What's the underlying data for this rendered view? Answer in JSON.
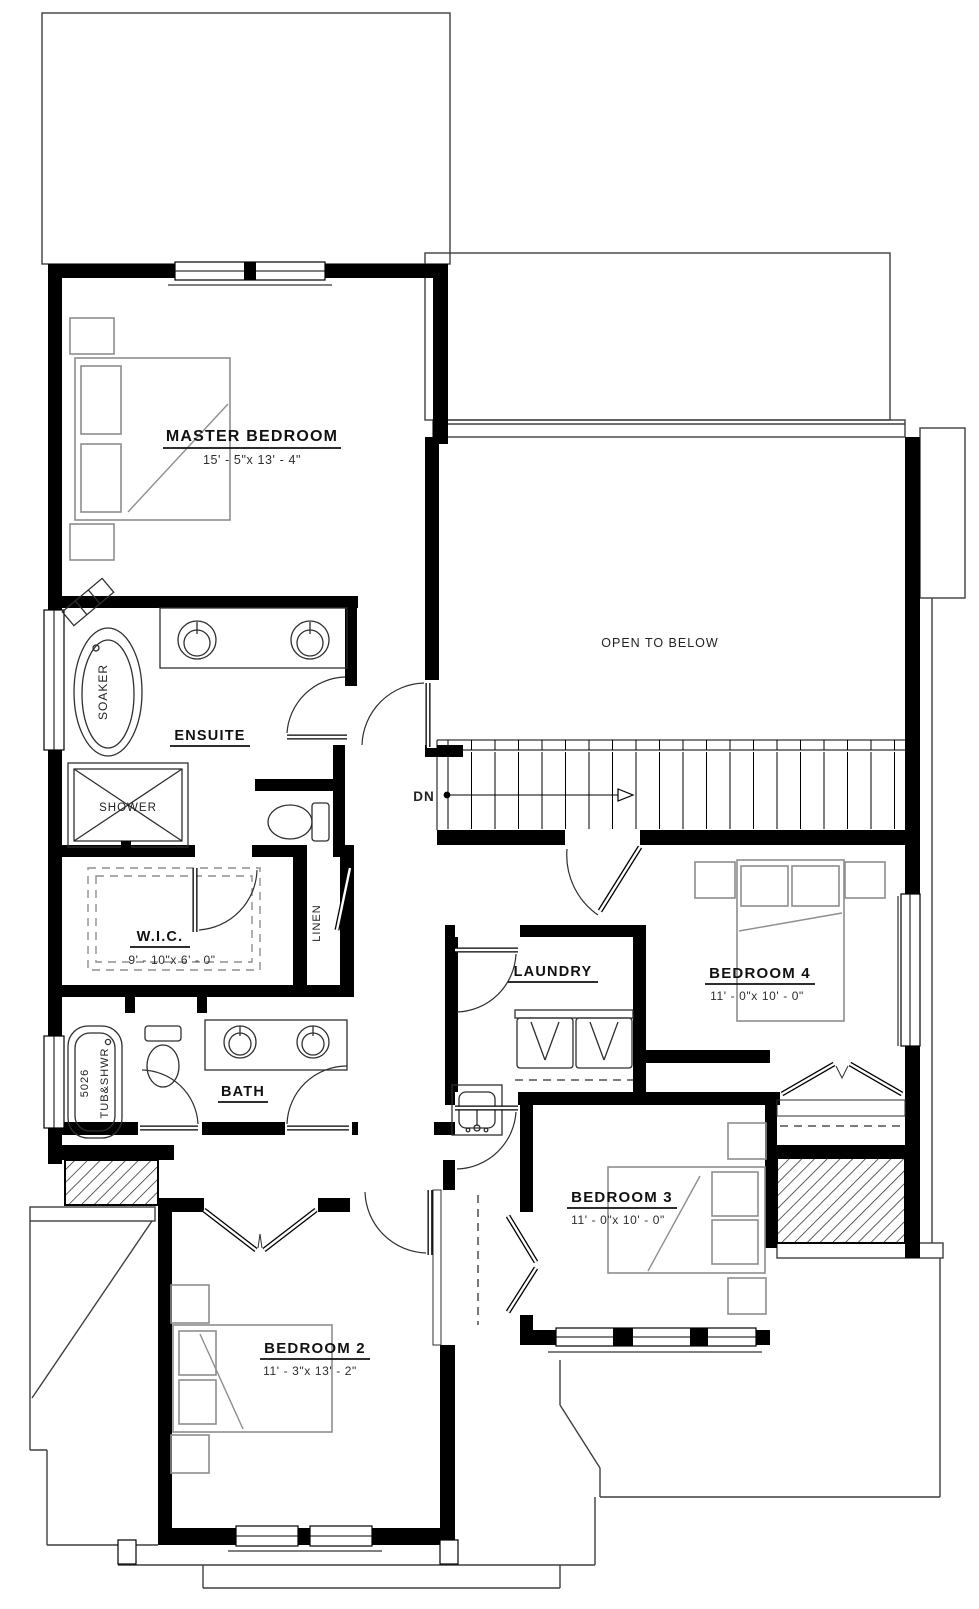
{
  "rooms": {
    "master_bedroom": {
      "label": "MASTER BEDROOM",
      "dims": "15' - 5\"x 13' - 4\""
    },
    "ensuite": {
      "label": "ENSUITE"
    },
    "wic": {
      "label": "W.I.C.",
      "dims": "9' - 10\"x 6' - 0\""
    },
    "linen": {
      "label": "LINEN"
    },
    "bath": {
      "label": "BATH"
    },
    "laundry": {
      "label": "LAUNDRY"
    },
    "bedroom4": {
      "label": "BEDROOM 4",
      "dims": "11' - 0\"x 10' - 0\""
    },
    "bedroom3": {
      "label": "BEDROOM 3",
      "dims": "11' - 0\"x 10' - 0\""
    },
    "bedroom2": {
      "label": "BEDROOM 2",
      "dims": "11' - 3\"x 13' - 2\""
    },
    "open_to_below": {
      "label": "OPEN TO BELOW"
    }
  },
  "fixtures": {
    "soaker_tub": "SOAKER",
    "shower": "SHOWER",
    "tub_shower_model": "5026",
    "tub_shower_type": "TUB&SHWR"
  },
  "stairs": {
    "down_label": "DN"
  },
  "colors": {
    "wall": "#000000",
    "roofline": "#3f3f3f",
    "furniture": "#8e8e8e",
    "text": "#111111"
  }
}
